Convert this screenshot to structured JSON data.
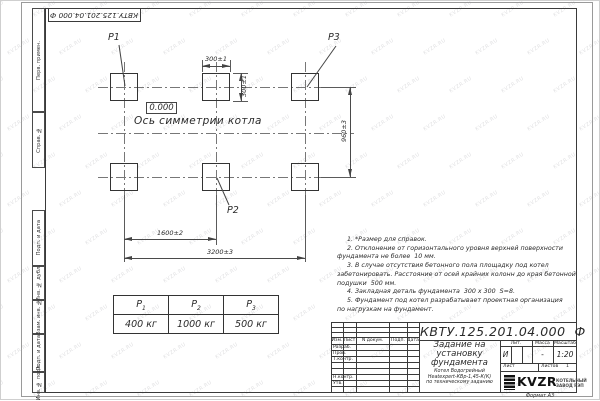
{
  "doc_code_stamp": "КВТУ.125.201.04.000 Ф",
  "watermark": {
    "text": "KVZR.RU"
  },
  "margin_columns": [
    "Перв. примен.",
    "Справ. №",
    "Подп. и дата",
    "Инв. № дубл.",
    "Взам. инв. №",
    "Подп. и дата",
    "Инв. № подл."
  ],
  "drawing": {
    "point_labels": {
      "p1": "Р1",
      "p2": "Р2",
      "p3": "Р3"
    },
    "elevation_mark": "0.000",
    "axis_label": "Ось симметрии котла",
    "dimensions": {
      "width_top": "300±1",
      "height_right": "300±1",
      "row_spacing": "960±3",
      "col_spacing": "1600±2",
      "total_width": "3200±3"
    }
  },
  "load_table": {
    "headers": [
      {
        "base": "Р",
        "sub": "1"
      },
      {
        "base": "Р",
        "sub": "2"
      },
      {
        "base": "Р",
        "sub": "3"
      }
    ],
    "values": [
      "400 кг",
      "1000 кг",
      "500 кг"
    ]
  },
  "notes": [
    "1. *Размер для справок.",
    "2. Отклонение от горизонтального уровня верхней поверхности",
    "фундамента не более  10 мм.",
    "3. В случае отсутствия бетонного пола площадку под котел",
    "забетонировать. Расстояние от осей крайних колонн до края бетонной",
    "подушки  500 мм.",
    "4. Закладная деталь фундамента  300 x 300  S=8.",
    "5. Фундамент под котел разрабатывает проектная организация",
    "по нагрузкам на фундамент."
  ],
  "title_block": {
    "designation": "КВТУ.125.201.04.000  Ф",
    "title_lines": [
      "Задание на",
      "установку",
      "фундамента"
    ],
    "product_lines": [
      "Котел Водогрейный",
      "Heatexpert-КВр-1,45-К(К)",
      "по техническому заданию"
    ],
    "header_row": [
      "Изм.",
      "Лист",
      "N докум.",
      "Подп.",
      "Дата"
    ],
    "signature_rows": [
      "Разраб.",
      "Пров.",
      "Т.контр.",
      "Н.контр.",
      "Утв."
    ],
    "lit_label": "Лит.",
    "mass_label": "Масса",
    "scale_label": "Масштаб",
    "lit_value": "И",
    "mass_value": "-",
    "scale_value": "1:20",
    "sheet_label": "Лист",
    "sheets_label": "Листов",
    "sheets_value": "1",
    "logo": {
      "name": "KVZR",
      "caption_lines": [
        "КОТЕЛЬНЫЙ",
        "ЗАВОД РЭП"
      ]
    }
  },
  "footer": {
    "format_label": "Формат А3"
  }
}
